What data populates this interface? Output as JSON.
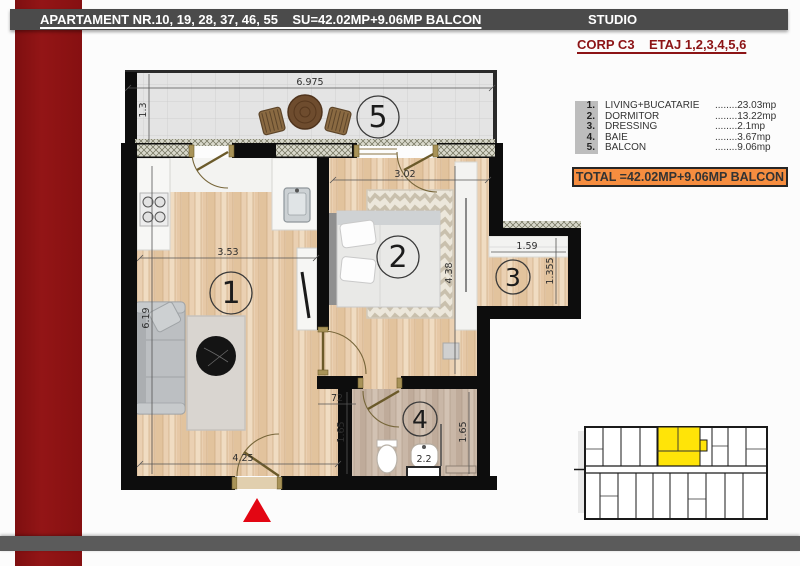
{
  "header": {
    "bar_title": "APARTAMENT NR.10, 19, 28, 37, 46, 55    SU=42.02MP+9.06MP BALCON",
    "bar_right": "STUDIO",
    "subheader": "CORP C3    ETAJ 1,2,3,4,5,6"
  },
  "legend": {
    "items": [
      {
        "num": "1.",
        "label": "LIVING+BUCATARIE",
        "value": "........23.03mp"
      },
      {
        "num": "2.",
        "label": "DORMITOR",
        "value": "........13.22mp"
      },
      {
        "num": "3.",
        "label": "DRESSING",
        "value": "........2.1mp"
      },
      {
        "num": "4.",
        "label": "BAIE",
        "value": "........3.67mp"
      },
      {
        "num": "5.",
        "label": "BALCON",
        "value": "........9.06mp"
      }
    ],
    "total": "TOTAL =42.02MP+9.06MP BALCON"
  },
  "plan": {
    "room_numbers": {
      "living": "1",
      "bedroom": "2",
      "dressing": "3",
      "bath": "4",
      "balcony": "5"
    },
    "dimensions": {
      "balcony_width": "6.975",
      "balcony_depth": "1.3",
      "living_width": "3.53",
      "living_height": "6.19",
      "living_bottom": "4.25",
      "bedroom_width": "3.02",
      "bedroom_height": "4.38",
      "dressing_width": "1.59",
      "dressing_depth": "1.355",
      "hall_width": "72",
      "bath_left": "1.65",
      "bath_right": "1.65",
      "bath_sink": "2.2"
    }
  },
  "colors": {
    "accent_red": "#8e1313",
    "triangle_red": "#e30613",
    "total_orange": "#f68d3f",
    "unit_highlight": "#ffe408"
  }
}
